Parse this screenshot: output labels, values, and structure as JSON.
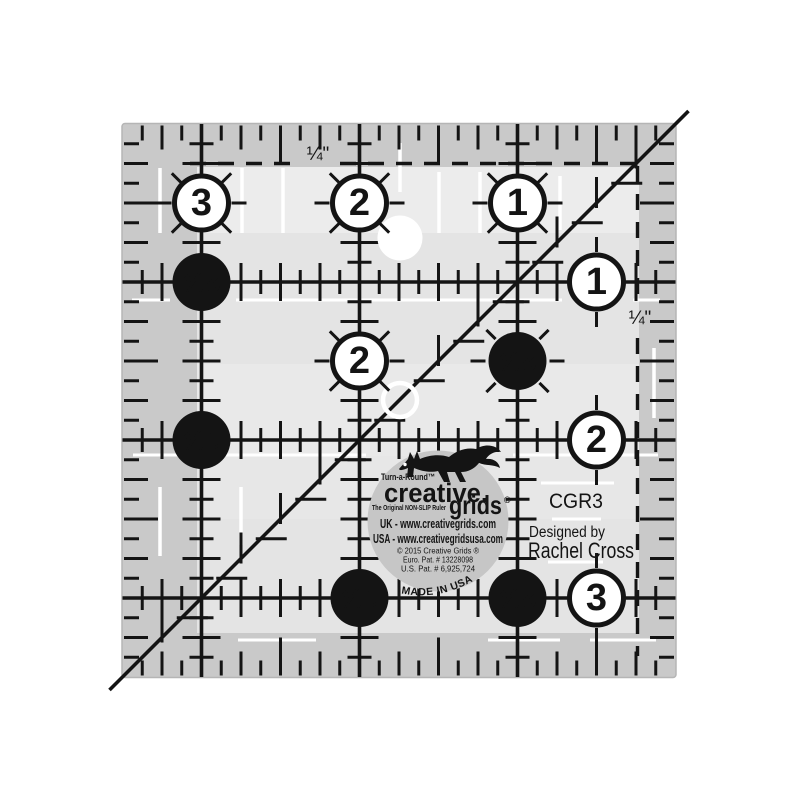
{
  "product": {
    "code": "CGR3",
    "designed_by_label": "Designed by",
    "designer": "Rachel Cross"
  },
  "labels": {
    "quarter_top": "¼\"",
    "quarter_right": "¼\""
  },
  "ruler": {
    "size_inches": 3.5,
    "circles": [
      {
        "col": 0.5,
        "row": 0.5,
        "label": "3",
        "style": "white"
      },
      {
        "col": 1.5,
        "row": 0.5,
        "label": "2",
        "style": "white"
      },
      {
        "col": 2.5,
        "row": 0.5,
        "label": "1",
        "style": "white"
      },
      {
        "col": 0.5,
        "row": 1.0,
        "label": "2½",
        "style": "black"
      },
      {
        "col": 3.0,
        "row": 1.0,
        "label": "1",
        "style": "white"
      },
      {
        "col": 1.5,
        "row": 1.5,
        "label": "2",
        "style": "white"
      },
      {
        "col": 2.5,
        "row": 1.5,
        "label": "2½",
        "style": "black"
      },
      {
        "col": 0.5,
        "row": 2.0,
        "label": "1½",
        "style": "black"
      },
      {
        "col": 3.0,
        "row": 2.0,
        "label": "2",
        "style": "white"
      },
      {
        "col": 1.5,
        "row": 3.0,
        "label": "1½",
        "style": "black"
      },
      {
        "col": 2.5,
        "row": 3.0,
        "label": "2½",
        "style": "black"
      },
      {
        "col": 3.0,
        "row": 3.0,
        "label": "3",
        "style": "white"
      }
    ]
  },
  "logo": {
    "turnaround": "Turn-a-Round™",
    "brand_line1": "creative.",
    "brand_line2": "grids",
    "registered": "®",
    "tagline": "The Original NON-SLIP Ruler",
    "uk_line": "UK - www.creativegrids.com",
    "usa_line": "USA - www.creativegridsusa.com",
    "copyright_line": "© 2015  Creative Grids ®",
    "euro_patent": "Euro. Pat. # 13228098",
    "us_patent": "U.S. Pat. # 6,925,724",
    "made_in": "MADE IN USA"
  },
  "colors": {
    "ink": "#141414",
    "ruler_edge_band": "#c9c9c9",
    "ruler_inner": "#e4e4e4",
    "logo_disc": "#c6c6c6",
    "white_print": "#ffffff"
  }
}
